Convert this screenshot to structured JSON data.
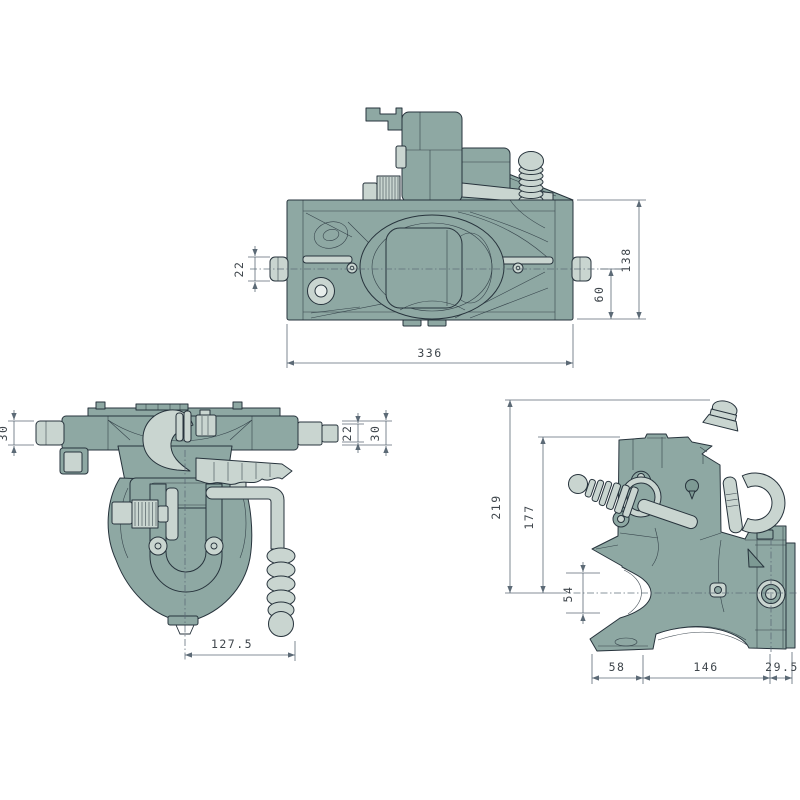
{
  "dims": {
    "front": {
      "pin": "22",
      "overall_height": "138",
      "center_to_base": "60",
      "overall_width": "336"
    },
    "plan": {
      "left_pin": "30",
      "right_pin_inner": "22",
      "right_pin_outer": "30",
      "center_to_grip": "127.5"
    },
    "side": {
      "overall_height": "219",
      "body_height": "177",
      "eye_center_span": "54",
      "jaw_depth": "58",
      "body_length": "146",
      "rear_offset": "29.5"
    }
  },
  "colors": {
    "body": "#8ea8a3",
    "body-dark": "#7d9a94",
    "light": "#c9d5d0",
    "lighter": "#e7edeb",
    "outline": "#27333c",
    "dim": "#5c6a76",
    "dim-text": "#3f464c",
    "bg": "#ffffff"
  }
}
